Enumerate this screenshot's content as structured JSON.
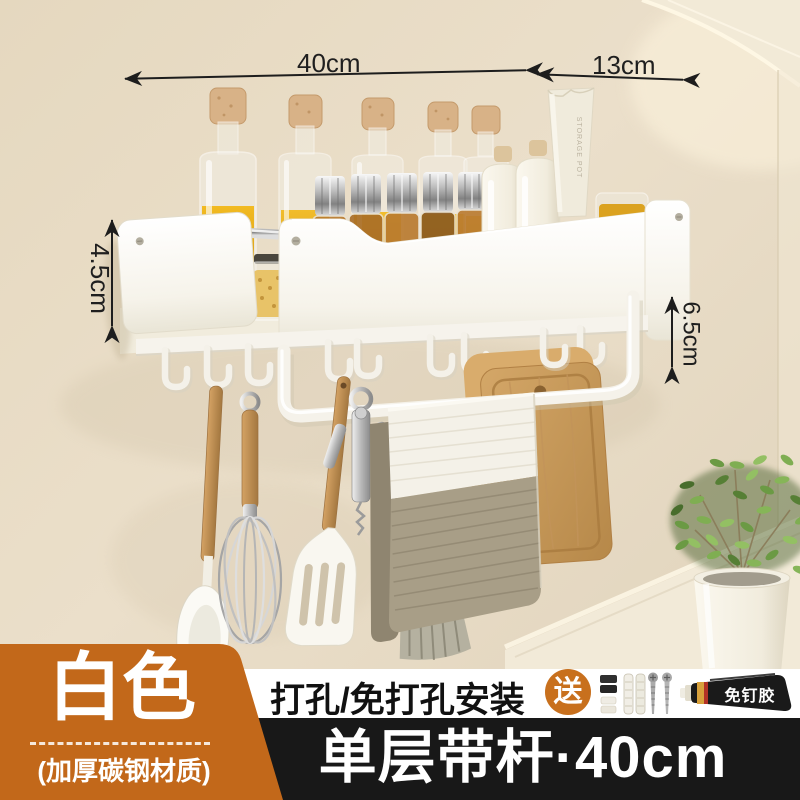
{
  "dimensions": {
    "shelf_width": "40cm",
    "side_depth": "13cm",
    "left_height": "4.5cm",
    "right_gap": "6.5cm"
  },
  "labels": {
    "color_name": "白色",
    "material_note": "(加厚碳钢材质)",
    "install_method": "打孔/免打孔安装",
    "gift_badge": "送",
    "glue_tube": "免钉胶",
    "product_spec": "单层带杆·40cm",
    "cup_print": "STORAGE POT"
  },
  "colors": {
    "accent_orange": "#c2681a",
    "bar_black": "#181818",
    "band_white": "#ffffff",
    "wall_beige": "#e7dbc4",
    "dimension_ink": "#1f1f1f",
    "towel_taupe": "#a89e87",
    "wood": "#c89a5c"
  }
}
